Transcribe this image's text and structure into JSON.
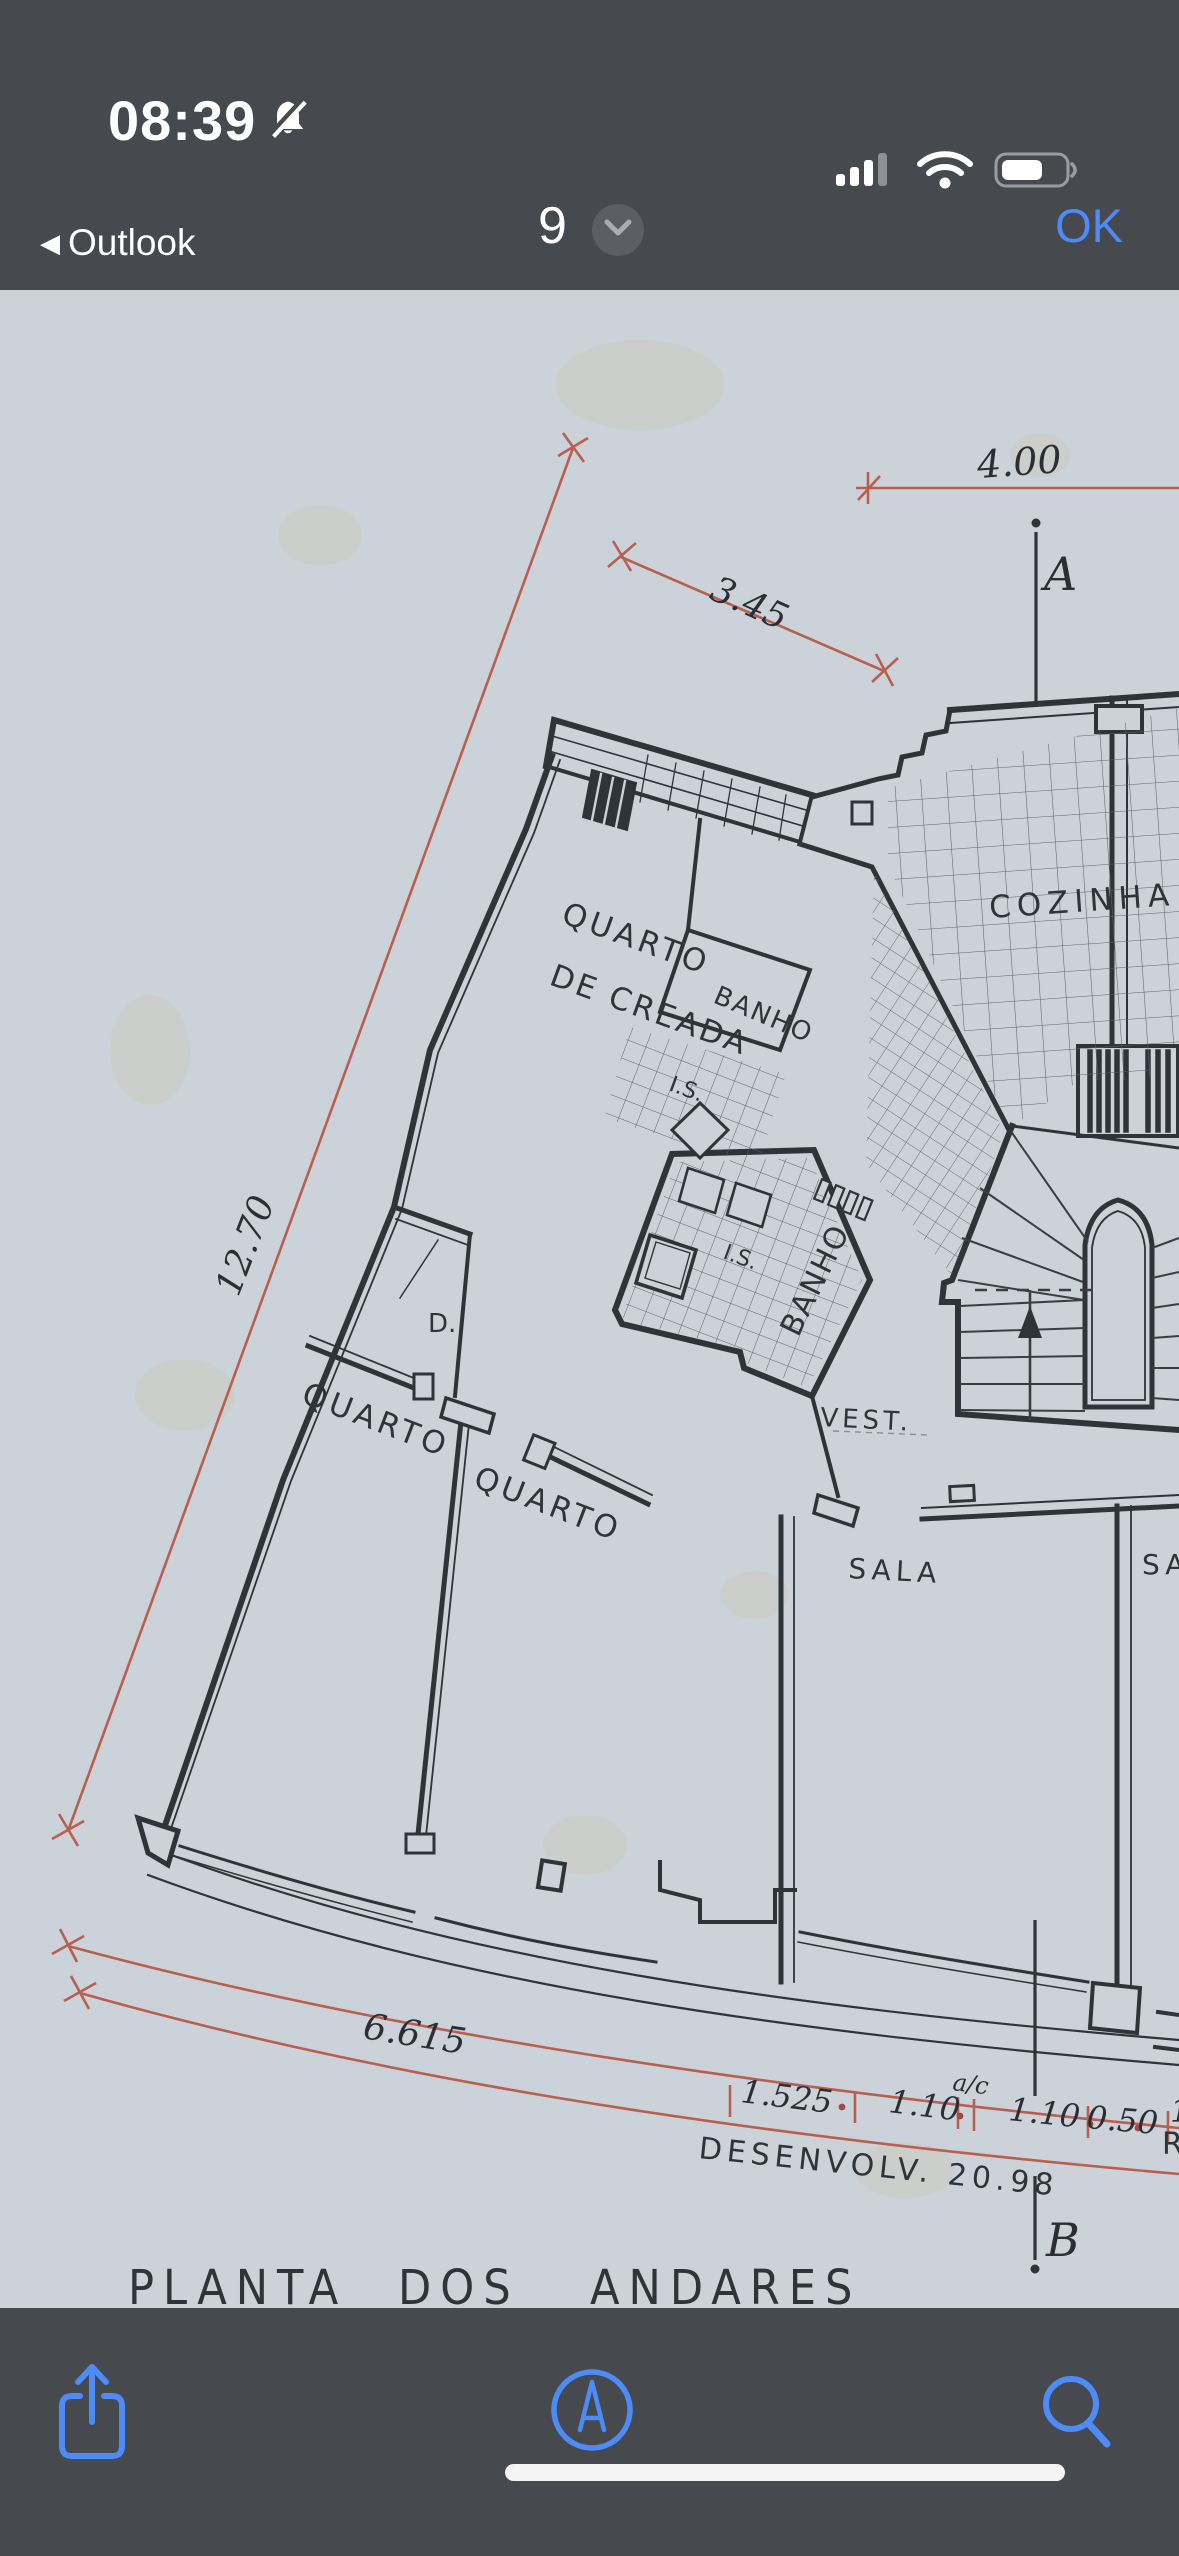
{
  "status": {
    "time": "08:39",
    "back_label": "Outlook",
    "back_chevron": "◀",
    "icons": [
      "bell-slash-icon",
      "cellular-signal-icon",
      "wifi-icon",
      "battery-icon"
    ],
    "battery_level_percent": 60,
    "cellular_bars_filled": 3
  },
  "nav": {
    "page_indicator": "9",
    "ok_label": "OK",
    "chevron_icon": "chevron-down-icon"
  },
  "plan": {
    "title_words": [
      "PLANTA",
      "DOS",
      "ANDARES"
    ],
    "title": "PLANTA DOS ANDARES",
    "labels": {
      "quarto_creada_1": "QUARTO",
      "quarto_creada_2": "DE CREADA",
      "banho_small": "BANHO",
      "is_upper": "I.S.",
      "is_lower": "I.S.",
      "banho_main": "BANHO",
      "cozinha": "COZINHA",
      "closet": "D.",
      "quarto_left": "QUARTO",
      "quarto_mid": "QUARTO",
      "vest": "VEST.",
      "sala": "SALA",
      "sala_partial": "SA",
      "section_a": "A",
      "section_b": "B",
      "partial_r": "R"
    },
    "dimensions": {
      "top": "4.00",
      "diag": "3.45",
      "left": "12.70",
      "arc": "6.615",
      "seg1": "1.525",
      "seg2": "1.10",
      "seg2_sup": "a/c",
      "seg3": "1.10",
      "seg4": "0.50",
      "seg5_partial": "1",
      "developed": "DESENVOLV.  20.98"
    }
  },
  "toolbar": {
    "icons": [
      "share-icon",
      "markup-compass-icon",
      "search-icon"
    ],
    "home_indicator": "home-indicator"
  },
  "colors": {
    "chrome_bg": "#46494d",
    "accent_blue": "#4d8bf8",
    "paper": "#ccd2da",
    "ink": "#2f333a",
    "dimension_red": "#b95f4e"
  }
}
